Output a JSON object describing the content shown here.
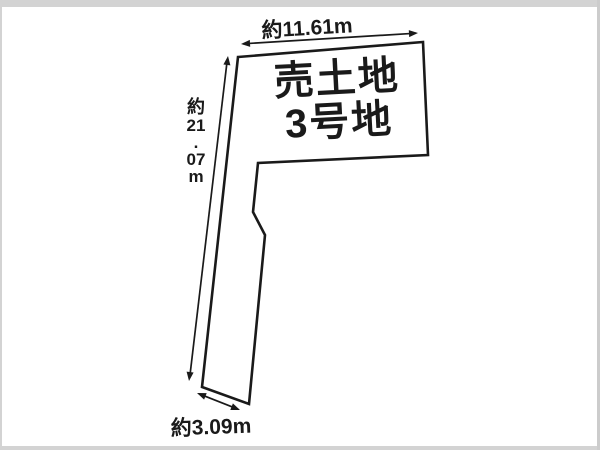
{
  "diagram": {
    "parcel_label": {
      "line1": "売土地",
      "line2": "3号地"
    },
    "dimensions": {
      "top": "約11.61m",
      "left": "約21.07m",
      "left_stack": [
        "約",
        "21",
        ".",
        "07",
        "m"
      ],
      "bottom": "約3.09m"
    },
    "colors": {
      "line": "#1a1a1a",
      "background": "#ffffff",
      "frame": "#d3d3d3"
    }
  }
}
